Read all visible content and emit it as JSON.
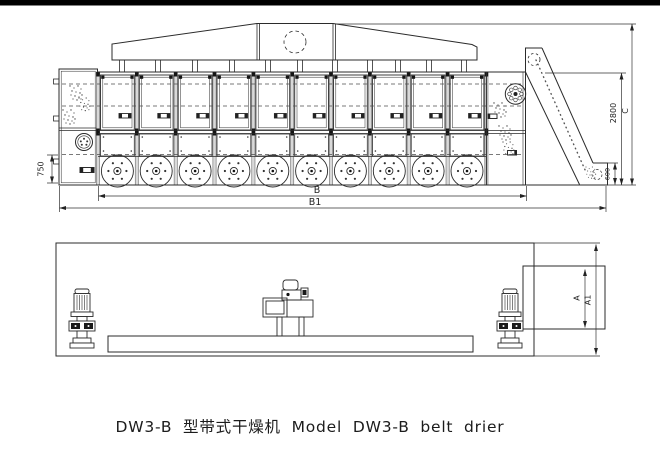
{
  "title_caption": "DW3-B 型带式干燥机 Model DW3-B belt drier",
  "side_view": {
    "dim_feed_height": "750",
    "dim_body_length": "B",
    "dim_overall_length": "B1",
    "dim_body_height": "2800",
    "dim_total_height": "C",
    "dim_outlet_height": "600"
  },
  "plan_view": {
    "dim_elevator_width": "A",
    "dim_overall_width": "A1"
  },
  "colors": {
    "ink": "#2b2b2b",
    "paper": "#ffffff",
    "scan_bar": "#000000"
  }
}
